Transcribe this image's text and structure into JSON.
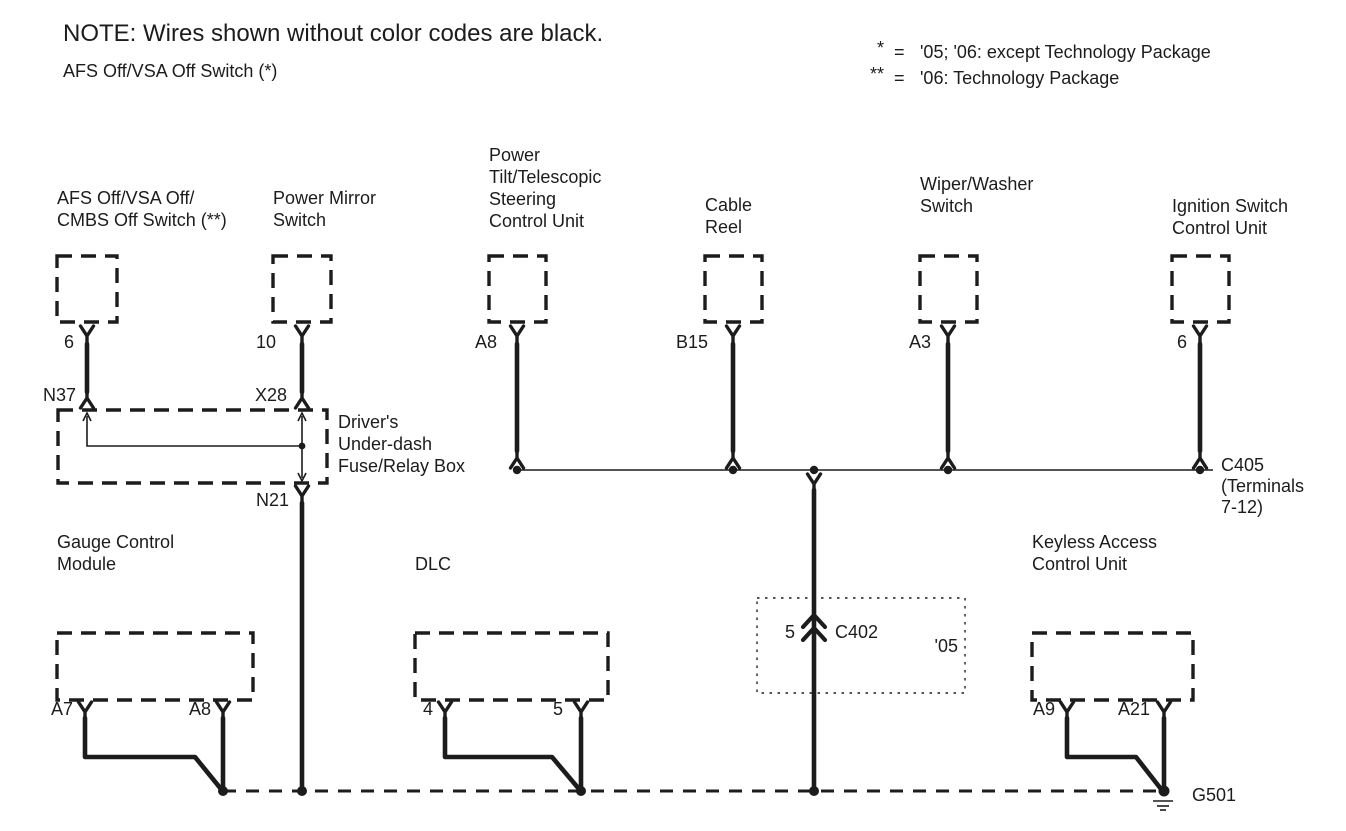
{
  "note": "NOTE: Wires shown without color codes are black.",
  "subtitle": "AFS Off/VSA Off Switch (*)",
  "legend": {
    "items": [
      {
        "symbol": "*",
        "eq": "=",
        "text": "'05; '06: except Technology Package"
      },
      {
        "symbol": "**",
        "eq": "=",
        "text": "'06: Technology Package"
      }
    ]
  },
  "components": {
    "afs_switch": {
      "label_lines": [
        "AFS Off/VSA Off/",
        "CMBS Off Switch (**)"
      ],
      "pin": "6",
      "connector": "N37"
    },
    "power_mirror_switch": {
      "label_lines": [
        "Power Mirror",
        "Switch"
      ],
      "pin": "10",
      "connector": "X28"
    },
    "fuse_box": {
      "label_lines": [
        "Driver's",
        "Under-dash",
        "Fuse/Relay Box"
      ],
      "exit_connector": "N21"
    },
    "steering_control_unit": {
      "label_lines": [
        "Power",
        "Tilt/Telescopic",
        "Steering",
        "Control Unit"
      ],
      "pin": "A8"
    },
    "cable_reel": {
      "label_lines": [
        "Cable",
        "Reel"
      ],
      "pin": "B15"
    },
    "wiper_washer_switch": {
      "label_lines": [
        "Wiper/Washer",
        "Switch"
      ],
      "pin": "A3"
    },
    "ignition_switch_control_unit": {
      "label_lines": [
        "Ignition Switch",
        "Control Unit"
      ],
      "pin": "6"
    },
    "gauge_control_module": {
      "label_lines": [
        "Gauge Control",
        "Module"
      ],
      "pin_left": "A7",
      "pin_right": "A8"
    },
    "dlc": {
      "label_lines": [
        "DLC"
      ],
      "pin_left": "4",
      "pin_right": "5"
    },
    "keyless_access_control_unit": {
      "label_lines": [
        "Keyless Access",
        "Control Unit"
      ],
      "pin_left": "A9",
      "pin_right": "A21"
    }
  },
  "connectors": {
    "c405": {
      "label_lines": [
        "C405",
        "(Terminals",
        "7-12)"
      ]
    },
    "c402": {
      "pin": "5",
      "name": "C402",
      "variant": "'05"
    },
    "ground": "G501"
  },
  "colors": {
    "ink": "#1c1c1c",
    "background": "#ffffff"
  }
}
